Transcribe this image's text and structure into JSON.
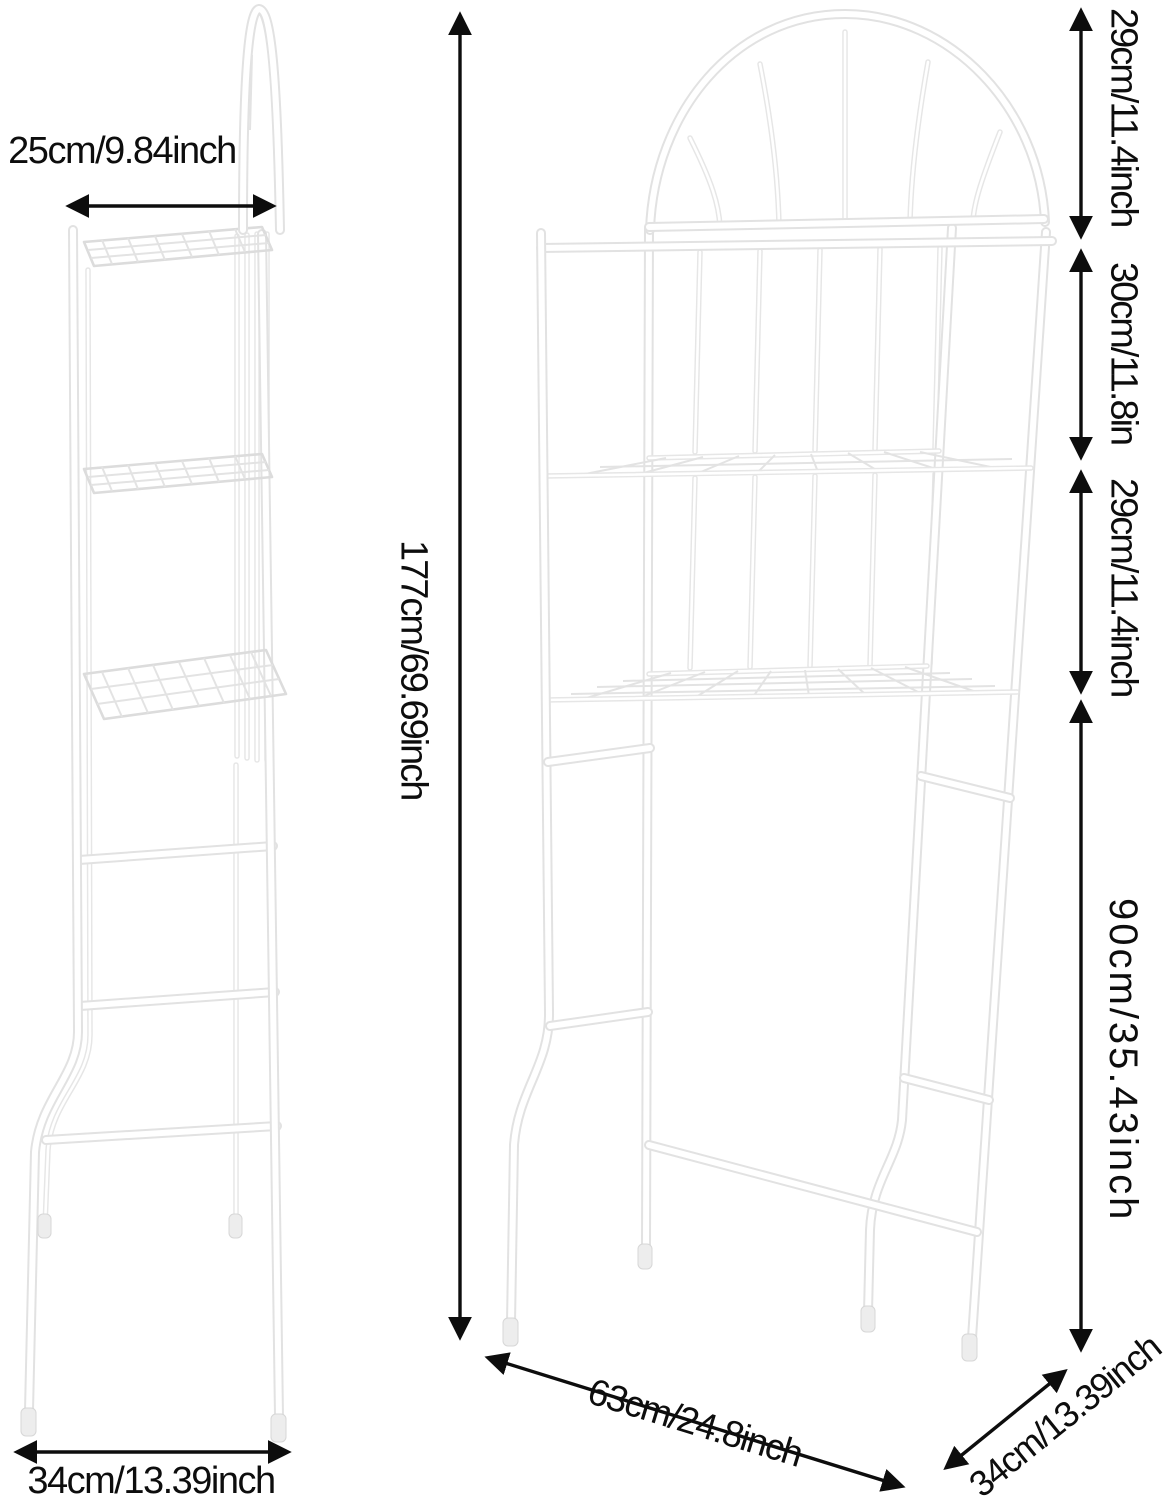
{
  "page": {
    "background": "#ffffff",
    "annotation_color": "#0d0d0d",
    "frame_fill_color": "#ffffff",
    "frame_edge_color": "#e2e2e2",
    "wire_color": "#e3e3e3",
    "foot_cap_color": "#ededed"
  },
  "product": {
    "type": "3-tier over-toilet storage shelf rack",
    "views": [
      "side-view",
      "front-view"
    ]
  },
  "dimensions": {
    "side_top_depth": "25cm/9.84inch",
    "total_height": "177cm/69.69inch",
    "arch_section_height": "29cm/11.4inch",
    "middle_section_height": "30cm/11.8in",
    "lower_section_height": "29cm/11.4inch",
    "clearance_height": "90cm/35.43inch",
    "front_width": "63cm/24.8inch",
    "base_depth_front_view": "34cm/13.39inch",
    "base_depth_side_view": "34cm/13.39inch"
  }
}
